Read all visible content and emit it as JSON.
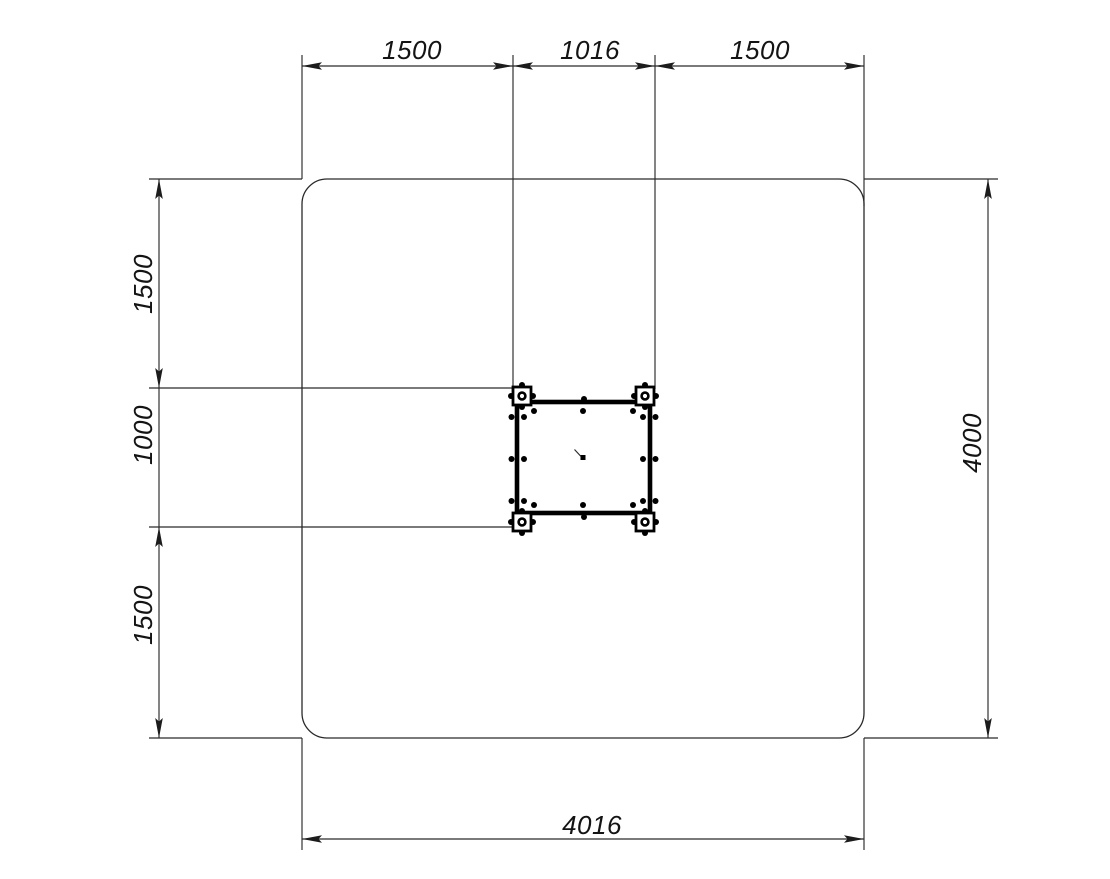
{
  "drawing": {
    "type": "technical-dimension-plan",
    "colors": {
      "background": "#ffffff",
      "line": "#2a2a2a",
      "equipment": "#000000",
      "text": "#141414"
    },
    "dimensions": {
      "top": {
        "segments": [
          "1500",
          "1016",
          "1500"
        ]
      },
      "left": {
        "segments": [
          "1500",
          "1000",
          "1500"
        ]
      },
      "right": {
        "label": "4000"
      },
      "bottom": {
        "label": "4016"
      }
    }
  }
}
